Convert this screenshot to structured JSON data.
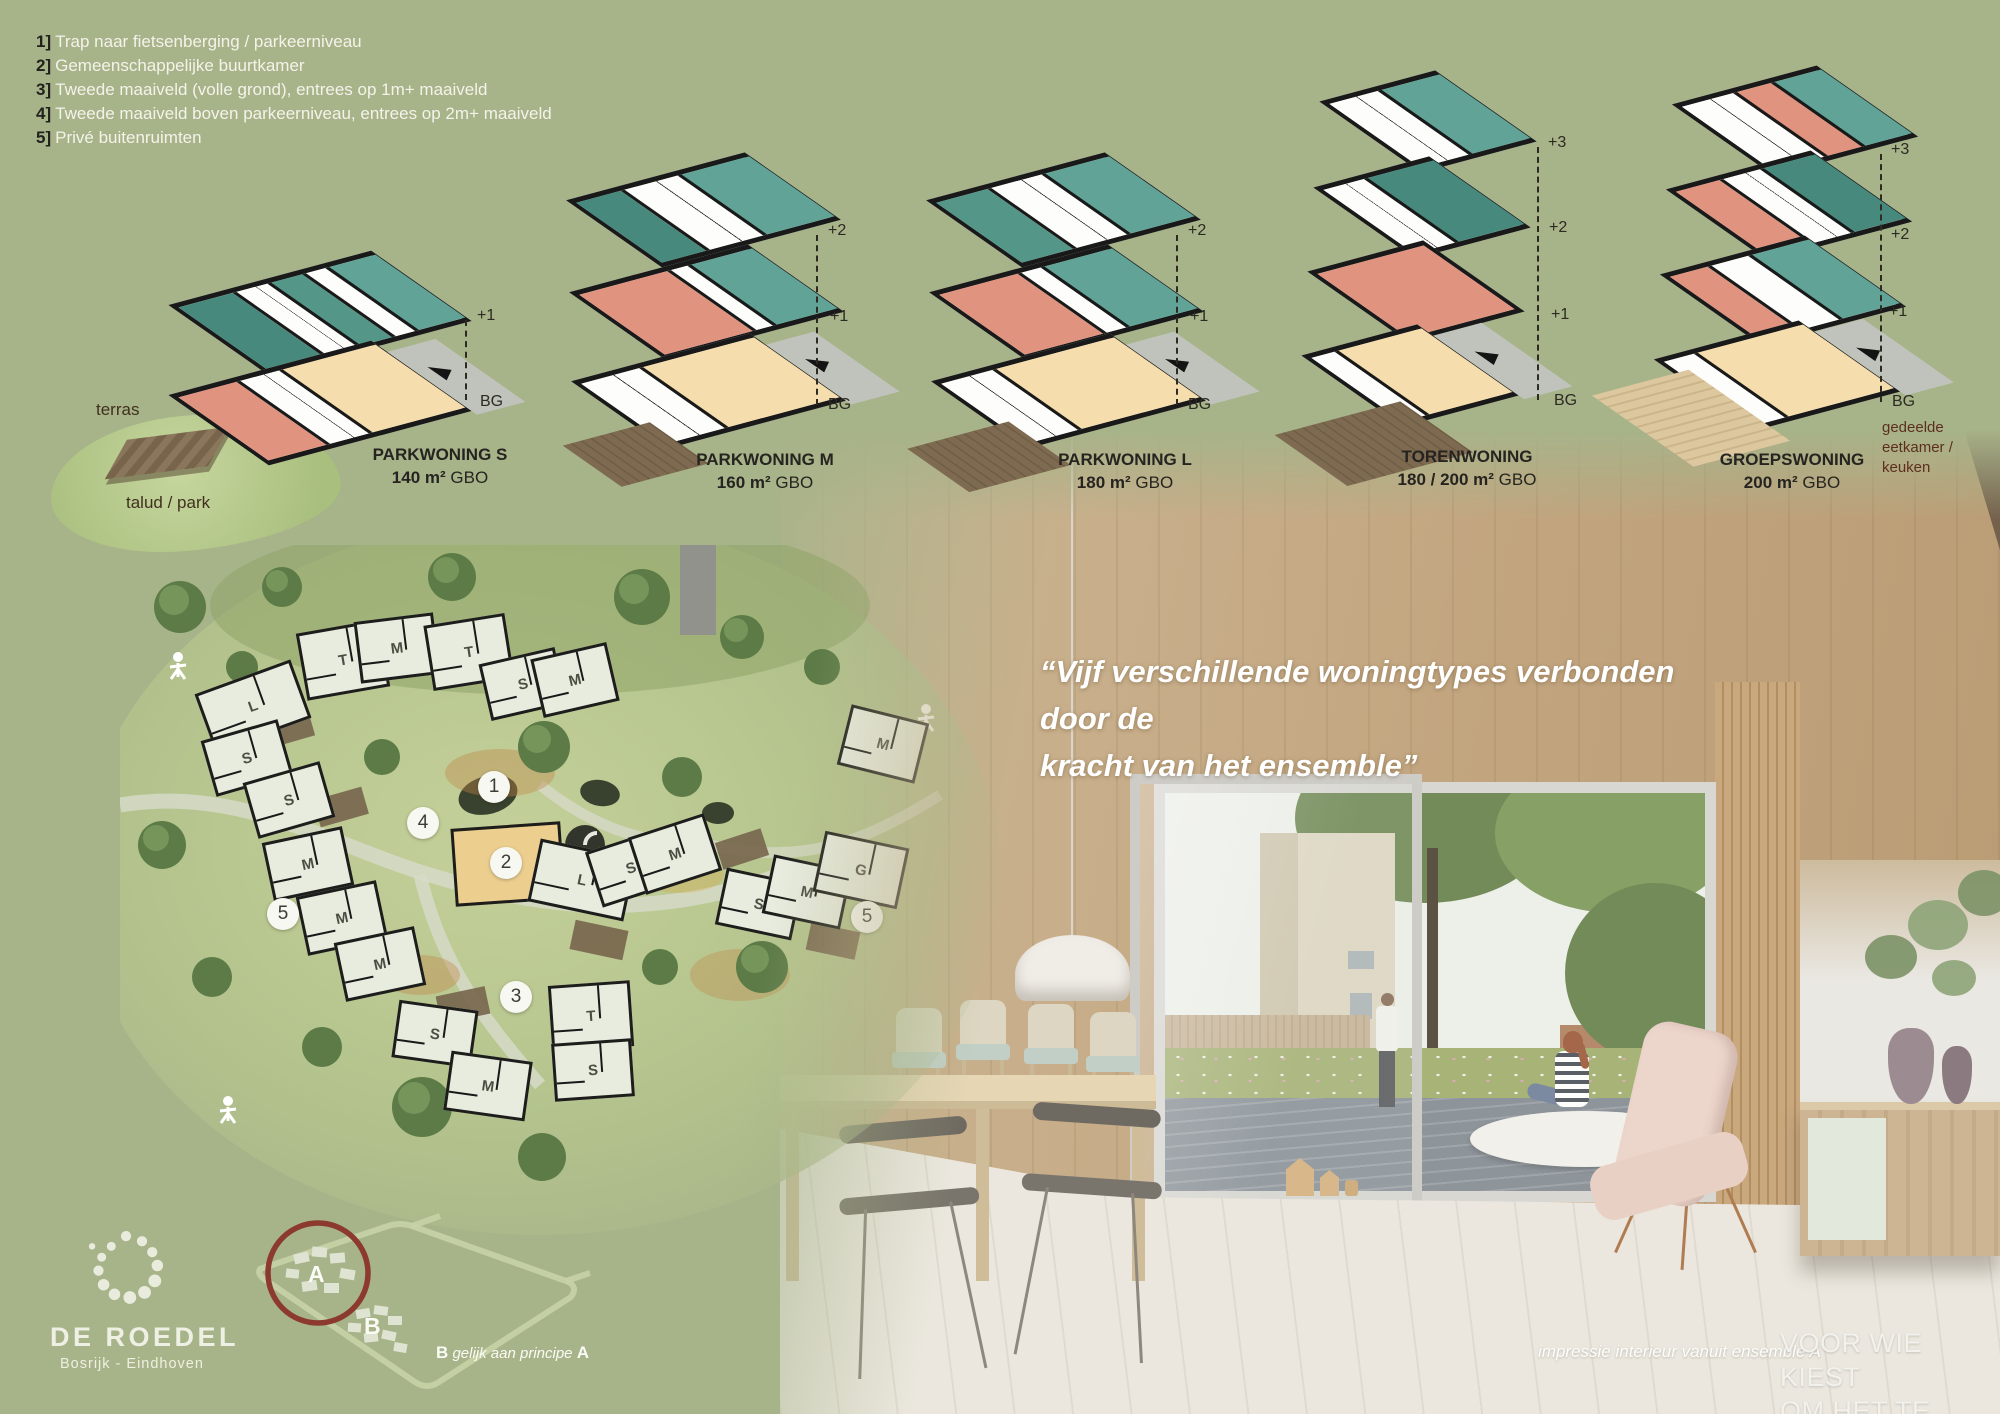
{
  "colors": {
    "background": "#a7b389",
    "teal_dark": "#478a7d",
    "teal_light": "#61a396",
    "salmon": "#e09480",
    "beige": "#f5ddad",
    "platform_gray": "#c0c3bb",
    "wall_black": "#191919",
    "accent_red": "#8c3a2d",
    "text_white": "#f3f3ea"
  },
  "legend": {
    "items": [
      {
        "num": "1]",
        "text": "Trap naar fietsenberging / parkeerniveau"
      },
      {
        "num": "2]",
        "text": "Gemeenschappelijke buurtkamer"
      },
      {
        "num": "3]",
        "text": "Tweede maaiveld (volle grond), entrees op 1m+ maaiveld"
      },
      {
        "num": "4]",
        "text": "Tweede maaiveld boven parkeerniveau, entrees op 2m+ maaiveld"
      },
      {
        "num": "5]",
        "text": "Privé buitenruimten"
      }
    ]
  },
  "diagrams": [
    {
      "name": "PARKWONING",
      "size": "S",
      "area": "140 m²",
      "unit": "GBO",
      "levels": [
        "+1",
        "BG"
      ],
      "terras": "terras",
      "talud": "talud / park"
    },
    {
      "name": "PARKWONING",
      "size": "M",
      "area": "160 m²",
      "unit": "GBO",
      "levels": [
        "+2",
        "+1",
        "BG"
      ]
    },
    {
      "name": "PARKWONING",
      "size": "L",
      "area": "180 m²",
      "unit": "GBO",
      "levels": [
        "+2",
        "+1",
        "BG"
      ]
    },
    {
      "name": "TORENWONING",
      "size": "",
      "area": "180 / 200 m²",
      "unit": "GBO",
      "levels": [
        "+3",
        "+2",
        "+1",
        "BG"
      ]
    },
    {
      "name": "GROEPSWONING",
      "size": "",
      "area": "200 m²",
      "unit": "GBO",
      "levels": [
        "+3",
        "+2",
        "+1",
        "BG"
      ],
      "bg_note": "gedeelde eetkamer / keuken"
    }
  ],
  "site_plan": {
    "buildings": [
      {
        "letter": "L",
        "x": 130,
        "y": 158,
        "w": 96,
        "h": 56,
        "r": -20
      },
      {
        "letter": "T",
        "x": 220,
        "y": 112,
        "w": 78,
        "h": 62,
        "r": -10
      },
      {
        "letter": "M",
        "x": 274,
        "y": 100,
        "w": 74,
        "h": 56,
        "r": -7
      },
      {
        "letter": "T",
        "x": 346,
        "y": 104,
        "w": 76,
        "h": 60,
        "r": -9
      },
      {
        "letter": "S",
        "x": 400,
        "y": 136,
        "w": 72,
        "h": 52,
        "r": -13
      },
      {
        "letter": "M",
        "x": 452,
        "y": 132,
        "w": 72,
        "h": 54,
        "r": -13
      },
      {
        "letter": "M",
        "x": 760,
        "y": 196,
        "w": 74,
        "h": 56,
        "r": 14
      },
      {
        "letter": "S",
        "x": 124,
        "y": 210,
        "w": 74,
        "h": 52,
        "r": -16
      },
      {
        "letter": "S",
        "x": 166,
        "y": 252,
        "w": 74,
        "h": 52,
        "r": -16
      },
      {
        "letter": "M",
        "x": 185,
        "y": 316,
        "w": 76,
        "h": 54,
        "r": -12
      },
      {
        "letter": "M",
        "x": 219,
        "y": 370,
        "w": 76,
        "h": 54,
        "r": -12
      },
      {
        "letter": "M",
        "x": 257,
        "y": 416,
        "w": 76,
        "h": 54,
        "r": -12
      },
      {
        "letter": "",
        "x": 385,
        "y": 316,
        "w": 104,
        "h": 72,
        "r": -4,
        "cls": "community"
      },
      {
        "letter": "L",
        "x": 459,
        "y": 332,
        "w": 92,
        "h": 58,
        "r": 12
      },
      {
        "letter": "S",
        "x": 508,
        "y": 320,
        "w": 72,
        "h": 52,
        "r": -18
      },
      {
        "letter": "M",
        "x": 552,
        "y": 306,
        "w": 74,
        "h": 54,
        "r": -18
      },
      {
        "letter": "S",
        "x": 636,
        "y": 356,
        "w": 72,
        "h": 52,
        "r": 12
      },
      {
        "letter": "M",
        "x": 684,
        "y": 344,
        "w": 74,
        "h": 54,
        "r": 12
      },
      {
        "letter": "G",
        "x": 738,
        "y": 322,
        "w": 80,
        "h": 56,
        "r": 12
      },
      {
        "letter": "S",
        "x": 312,
        "y": 486,
        "w": 74,
        "h": 52,
        "r": 8
      },
      {
        "letter": "M",
        "x": 365,
        "y": 538,
        "w": 76,
        "h": 54,
        "r": 8
      },
      {
        "letter": "T",
        "x": 468,
        "y": 468,
        "w": 76,
        "h": 60,
        "r": -4
      },
      {
        "letter": "S",
        "x": 470,
        "y": 522,
        "w": 74,
        "h": 52,
        "r": -4
      }
    ],
    "markers": [
      {
        "n": "1",
        "x": 374,
        "y": 242
      },
      {
        "n": "2",
        "x": 386,
        "y": 318
      },
      {
        "n": "3",
        "x": 396,
        "y": 452
      },
      {
        "n": "4",
        "x": 303,
        "y": 278
      },
      {
        "n": "5",
        "x": 163,
        "y": 369
      },
      {
        "n": "5",
        "x": 747,
        "y": 372
      }
    ]
  },
  "quote": {
    "line1": "“Vijf verschillende woningtypes verbonden door de",
    "line2": "kracht van het ensemble”"
  },
  "logo": {
    "title": "DE ROEDEL",
    "subtitle": "Bosrijk - Eindhoven"
  },
  "site_key": {
    "label_a": "A",
    "label_b": "B",
    "cap_b1": "B",
    "cap_mid": "gelijk aan principe",
    "cap_b2": "A"
  },
  "captions": {
    "interior": "impressie interieur vanuit ensemble A",
    "tagline1": "VOOR WIE KIEST",
    "tagline2": "OM HET TE DOEN."
  }
}
